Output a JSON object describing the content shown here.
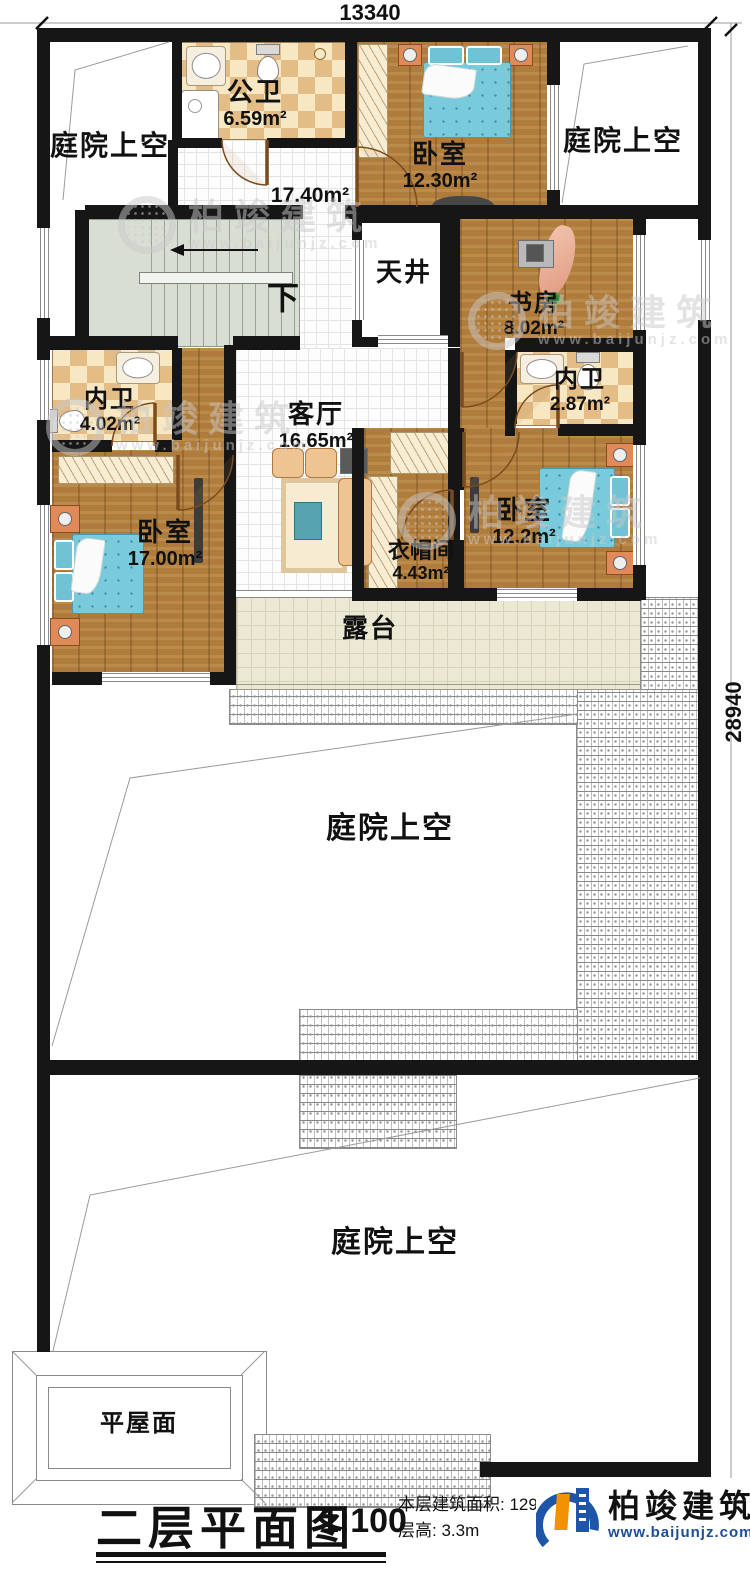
{
  "dimensions": {
    "top": "13340",
    "right": "28940"
  },
  "labels": {
    "down": "下"
  },
  "rooms": {
    "courtyard_top_left": {
      "name": "庭院上空"
    },
    "public_bath": {
      "name": "公卫",
      "area": "6.59m²"
    },
    "hall": {
      "area": "17.40m²"
    },
    "bedroom_top": {
      "name": "卧室",
      "area": "12.30m²"
    },
    "courtyard_top_right": {
      "name": "庭院上空"
    },
    "lightwell": {
      "name": "天井"
    },
    "study": {
      "name": "书房",
      "area": "8.02m²"
    },
    "bath_left": {
      "name": "内卫",
      "area": "4.02m²"
    },
    "bath_right": {
      "name": "内卫",
      "area": "2.87m²"
    },
    "living": {
      "name": "客厅",
      "area": "16.65m²"
    },
    "bedroom_left": {
      "name": "卧室",
      "area": "17.00m²"
    },
    "bedroom_right": {
      "name": "卧室",
      "area": "12.2m²"
    },
    "cloakroom": {
      "name": "衣帽间",
      "area": "4.43m²"
    },
    "terrace": {
      "name": "露台"
    },
    "courtyard_mid": {
      "name": "庭院上空"
    },
    "courtyard_bottom": {
      "name": "庭院上空"
    },
    "flat_roof": {
      "name": "平屋面"
    }
  },
  "footer": {
    "title": "二层平面图",
    "scale": "1:100",
    "area_line": "本层建筑面积: 129.0",
    "height_line": "层高: 3.3m"
  },
  "brand": {
    "name": "柏竣建筑",
    "url": "www.baijunjz.com"
  },
  "watermark": {
    "name": "柏竣建筑",
    "url": "www.baijunjz.com"
  },
  "colors": {
    "wall": "#161616",
    "wood": "#b07c3c",
    "bed": "#79cbdc",
    "accent_blue": "#1b4e9b",
    "accent_orange": "#f29200"
  }
}
